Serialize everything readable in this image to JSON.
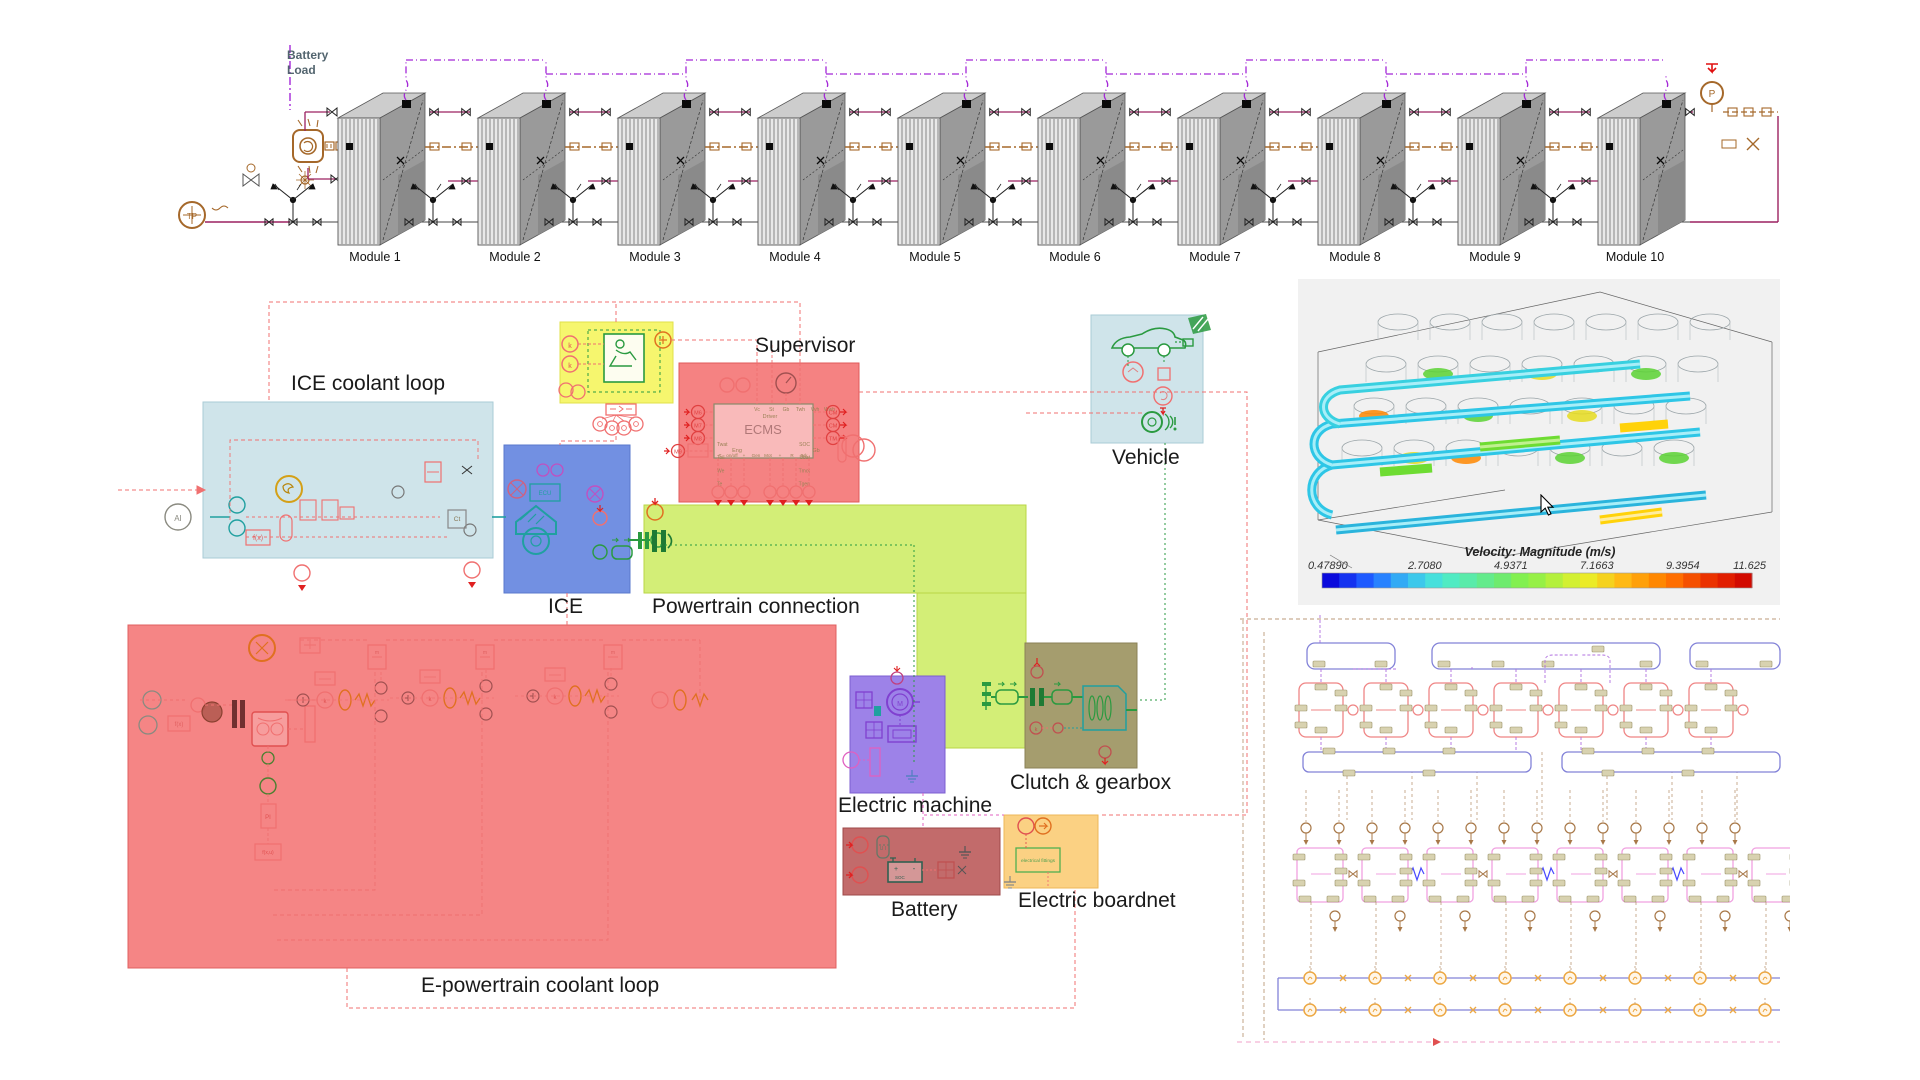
{
  "battery_chain": {
    "load_label": "Battery Load",
    "modules": [
      "Module 1",
      "Module 2",
      "Module 3",
      "Module 4",
      "Module 5",
      "Module 6",
      "Module 7",
      "Module 8",
      "Module 9",
      "Module 10"
    ],
    "pump_symbol": "P",
    "tp_symbol": "TP",
    "colors": {
      "hydraulic": "#9c2161",
      "signal": "#a428d8",
      "refrigerant": "#a5682a",
      "block_front": "#e8e8e8",
      "block_top": "#cdcdcd",
      "block_side": "#9a9a9a",
      "stripe": "#8f8f8f"
    }
  },
  "system_diagram": {
    "regions": [
      {
        "id": "ice_coolant_loop",
        "label": "ICE coolant loop",
        "color": "#cfe4ea",
        "border": "#aacbd6"
      },
      {
        "id": "driver_area",
        "label": "",
        "color": "#f6f66e",
        "border": "#e0e04a"
      },
      {
        "id": "supervisor",
        "label": "Supervisor",
        "color": "#f58282",
        "border": "#e05a5a"
      },
      {
        "id": "vehicle",
        "label": "Vehicle",
        "color": "#cfe4ea",
        "border": "#aacbd6"
      },
      {
        "id": "ice",
        "label": "ICE",
        "color": "#7290e2",
        "border": "#5a78cc"
      },
      {
        "id": "powertrain_connection",
        "label": "Powertrain connection",
        "color": "#d3ee77",
        "border": "#b9d646"
      },
      {
        "id": "epowertrain_coolant_loop",
        "label": "E-powertrain coolant loop",
        "color": "#f58585",
        "border": "#e06060"
      },
      {
        "id": "electric_machine",
        "label": "Electric machine",
        "color": "#9d82e8",
        "border": "#7c5fd0"
      },
      {
        "id": "clutch_gearbox",
        "label": "Clutch & gearbox",
        "color": "#a59d6e",
        "border": "#8a8157"
      },
      {
        "id": "battery",
        "label": "Battery",
        "color": "#c26b6b",
        "border": "#9e4848"
      },
      {
        "id": "electric_boardnet",
        "label": "Electric boardnet",
        "color": "#fbd183",
        "border": "#eeb75a"
      }
    ],
    "ecms": {
      "title": "ECMS",
      "driver_label": "Driver",
      "eng_label": "Eng",
      "gb_label": "Gb",
      "top_ports": [
        "Vc",
        "St",
        "Gb",
        "Twh",
        "Vvh",
        "Wwh"
      ],
      "left_ports": [
        "Twat",
        "Toil",
        "We",
        "Te"
      ],
      "right_ports": [
        "SOC",
        "Ubat",
        "Tmot",
        "Tgen"
      ],
      "bottom_ports": [
        "T",
        "on/off",
        "+",
        "Gen",
        "Mot",
        "+",
        "R",
        "Brk"
      ],
      "left_inputs": [
        "M6",
        "M7",
        "M8",
        "M9"
      ],
      "right_inputs": [
        "CM",
        "CM",
        "TM"
      ]
    },
    "glyphs": {
      "ai": "AI",
      "fx": "f(x)",
      "fxu": "f(x,u)",
      "pi": "PI",
      "mux": "MUX",
      "ct": "Ct",
      "k": "k",
      "m": "M",
      "ecu": "ECU",
      "fittings": "electrical fittings",
      "ui": "U I",
      "soc": "SOC"
    }
  },
  "cfd": {
    "title": "Velocity: Magnitude (m/s)",
    "ticks": [
      "0.47890",
      "2.7080",
      "4.9371",
      "7.1663",
      "9.3954",
      "11.625"
    ],
    "colorbar_colors": [
      "#0a0adc",
      "#1432f0",
      "#1e5aff",
      "#2882ff",
      "#32aaf5",
      "#3cc8eb",
      "#46e0dc",
      "#50ebc3",
      "#5aebaa",
      "#64eb8c",
      "#6eeb6e",
      "#82f050",
      "#96f046",
      "#b4f03c",
      "#d2f032",
      "#ebeb28",
      "#f5d21e",
      "#ffb914",
      "#ffa00a",
      "#ff8700",
      "#ff6e00",
      "#f55000",
      "#eb3200",
      "#e11e00",
      "#d20a00"
    ]
  },
  "cell_network": {
    "top_buses": 3,
    "cell_count": 7,
    "pink_cell_count": 8,
    "source_count": 14,
    "node_count": 8,
    "colors": {
      "bus": "#8282d8",
      "cell": "#ef8585",
      "pink": "#f0a0e0",
      "port": "#d8d2b0",
      "portedge": "#9a9268",
      "source": "#a87848",
      "node": "#eda843",
      "wire": "#bb9a78",
      "purple": "#b070e0",
      "blue": "#4848ff"
    }
  }
}
